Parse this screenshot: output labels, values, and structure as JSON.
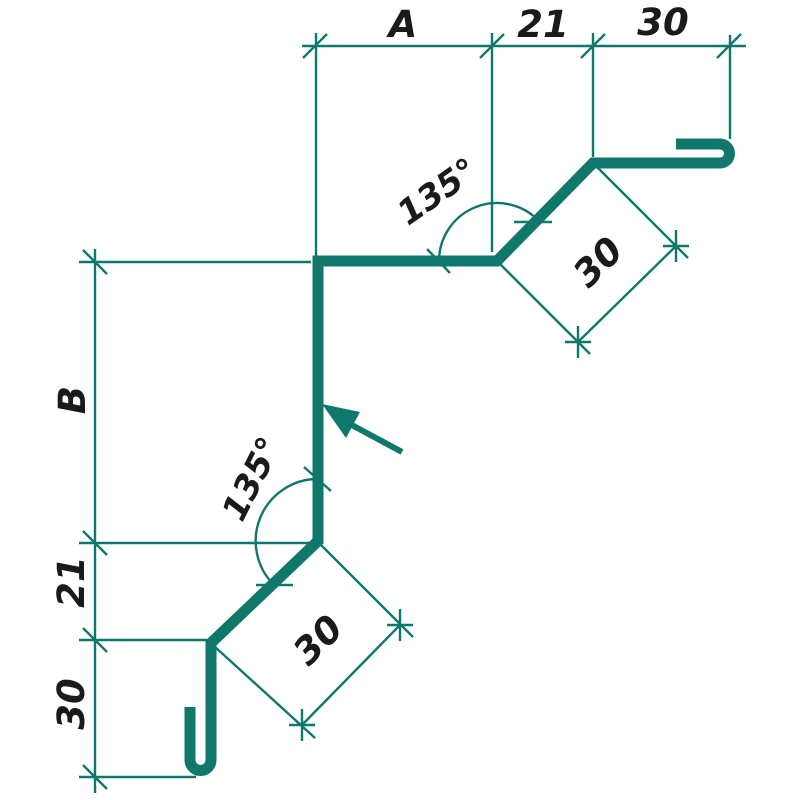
{
  "drawing": {
    "type": "sheet-metal-flashing-profile-drawing",
    "accent_color": "#0f786b",
    "text_color": "#1a1a1a",
    "background_color": "#ffffff",
    "dims_top": {
      "a": "A",
      "d21": "21",
      "d30": "30"
    },
    "dims_left": {
      "b": "B",
      "d21": "21",
      "d30": "30"
    },
    "dims_diag": {
      "upper": "30",
      "lower": "30"
    },
    "angles": {
      "upper": "135°",
      "lower": "135°"
    }
  }
}
